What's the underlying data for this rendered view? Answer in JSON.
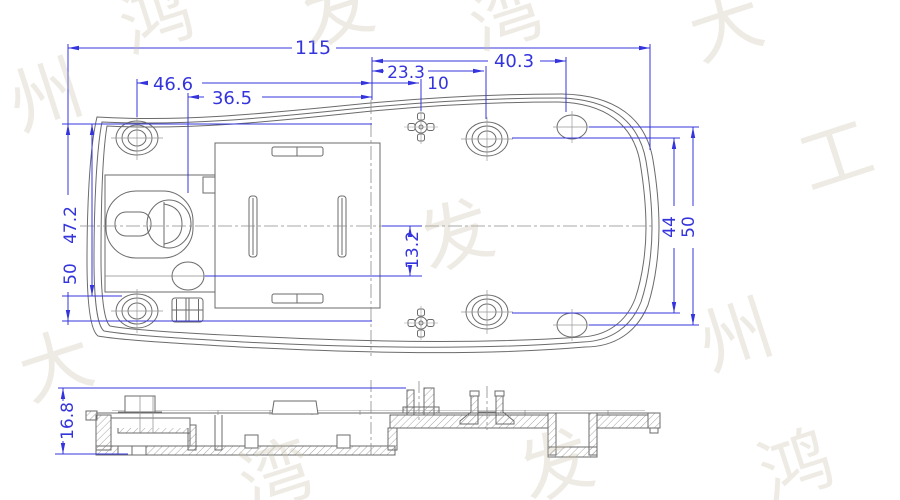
{
  "drawing": {
    "type": "engineering-cad-drawing",
    "colors": {
      "dimension_blue": "#3434dc",
      "geometry_gray": "#6b6b6b",
      "hatch_gray": "#9a9a9a",
      "watermark": "#e9e2d6"
    },
    "dimensions": {
      "overall_width": "115",
      "right_hole_offset": "40.3",
      "center_hole_offset": "23.3",
      "boss_offset": "10",
      "left_hole_offset": "46.6",
      "keyhole_offset": "36.5",
      "slot_to_center": "13.2",
      "hole_row_span": "44",
      "right_span": "50",
      "left_inner_span": "47.2",
      "left_span": "50",
      "section_height": "16.8"
    },
    "watermark": {
      "glyphs": [
        "鸿",
        "发",
        "湾",
        "大",
        "工",
        "州",
        "鸿",
        "发",
        "湾",
        "大",
        "州",
        "发"
      ]
    }
  }
}
